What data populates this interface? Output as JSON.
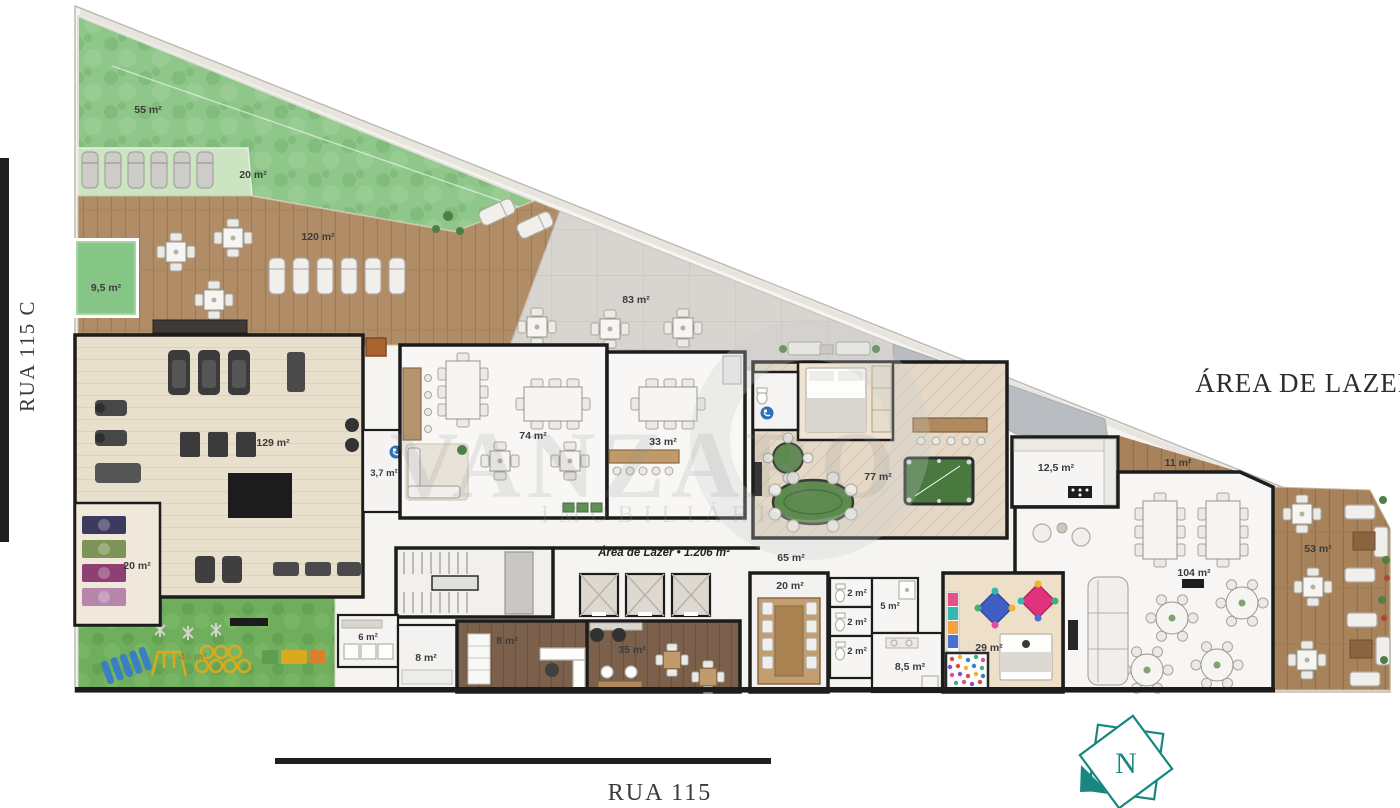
{
  "streets": {
    "left": "RUA 115 C",
    "bottom": "RUA 115"
  },
  "plan": {
    "sector_title": "ÁREA DE LAZER",
    "total_area_label": "Área de Lazer • 1.206 m²",
    "compass_letter": "N"
  },
  "watermark": {
    "line1": "VANZARO",
    "line2": "IMOBILIÁRIA"
  },
  "areas": {
    "lawn": "55 m²",
    "sun_lounge": "20 m²",
    "wood_deck": "120 m²",
    "plunge_pool": "9,5 m²",
    "stone_terrace": "83 m²",
    "gym": "129 m²",
    "yoga_studio": "20 m²",
    "gym_wc": "3,7 m²",
    "party_room": "74 m²",
    "dining_room": "33 m²",
    "games_room": "77 m²",
    "gourmet_kitchen": "12,5 m²",
    "side_corridor": "11 m²",
    "hall": "65 m²",
    "ballroom": "104 m²",
    "east_deck": "53 m²",
    "playground": "45 m²",
    "locker_room": "6 m²",
    "storage_front": "8 m²",
    "wine_cellar": "8 m²",
    "beauty_salon": "35 m²",
    "sauna": "20 m²",
    "wc_1": "2 m²",
    "wc_2": "2 m²",
    "wc_3": "2 m²",
    "shower": "5 m²",
    "restrooms": "8,5 m²",
    "kids_playroom": "29 m²"
  },
  "colors": {
    "accent_teal": "#19867f",
    "lawn_green": "#8fc689",
    "playground_green": "#6fae5c",
    "deck_wood": "#b18d67",
    "water_green": "#85c585",
    "billiard_green": "#49793f",
    "wall_black": "#1c1c1c"
  }
}
